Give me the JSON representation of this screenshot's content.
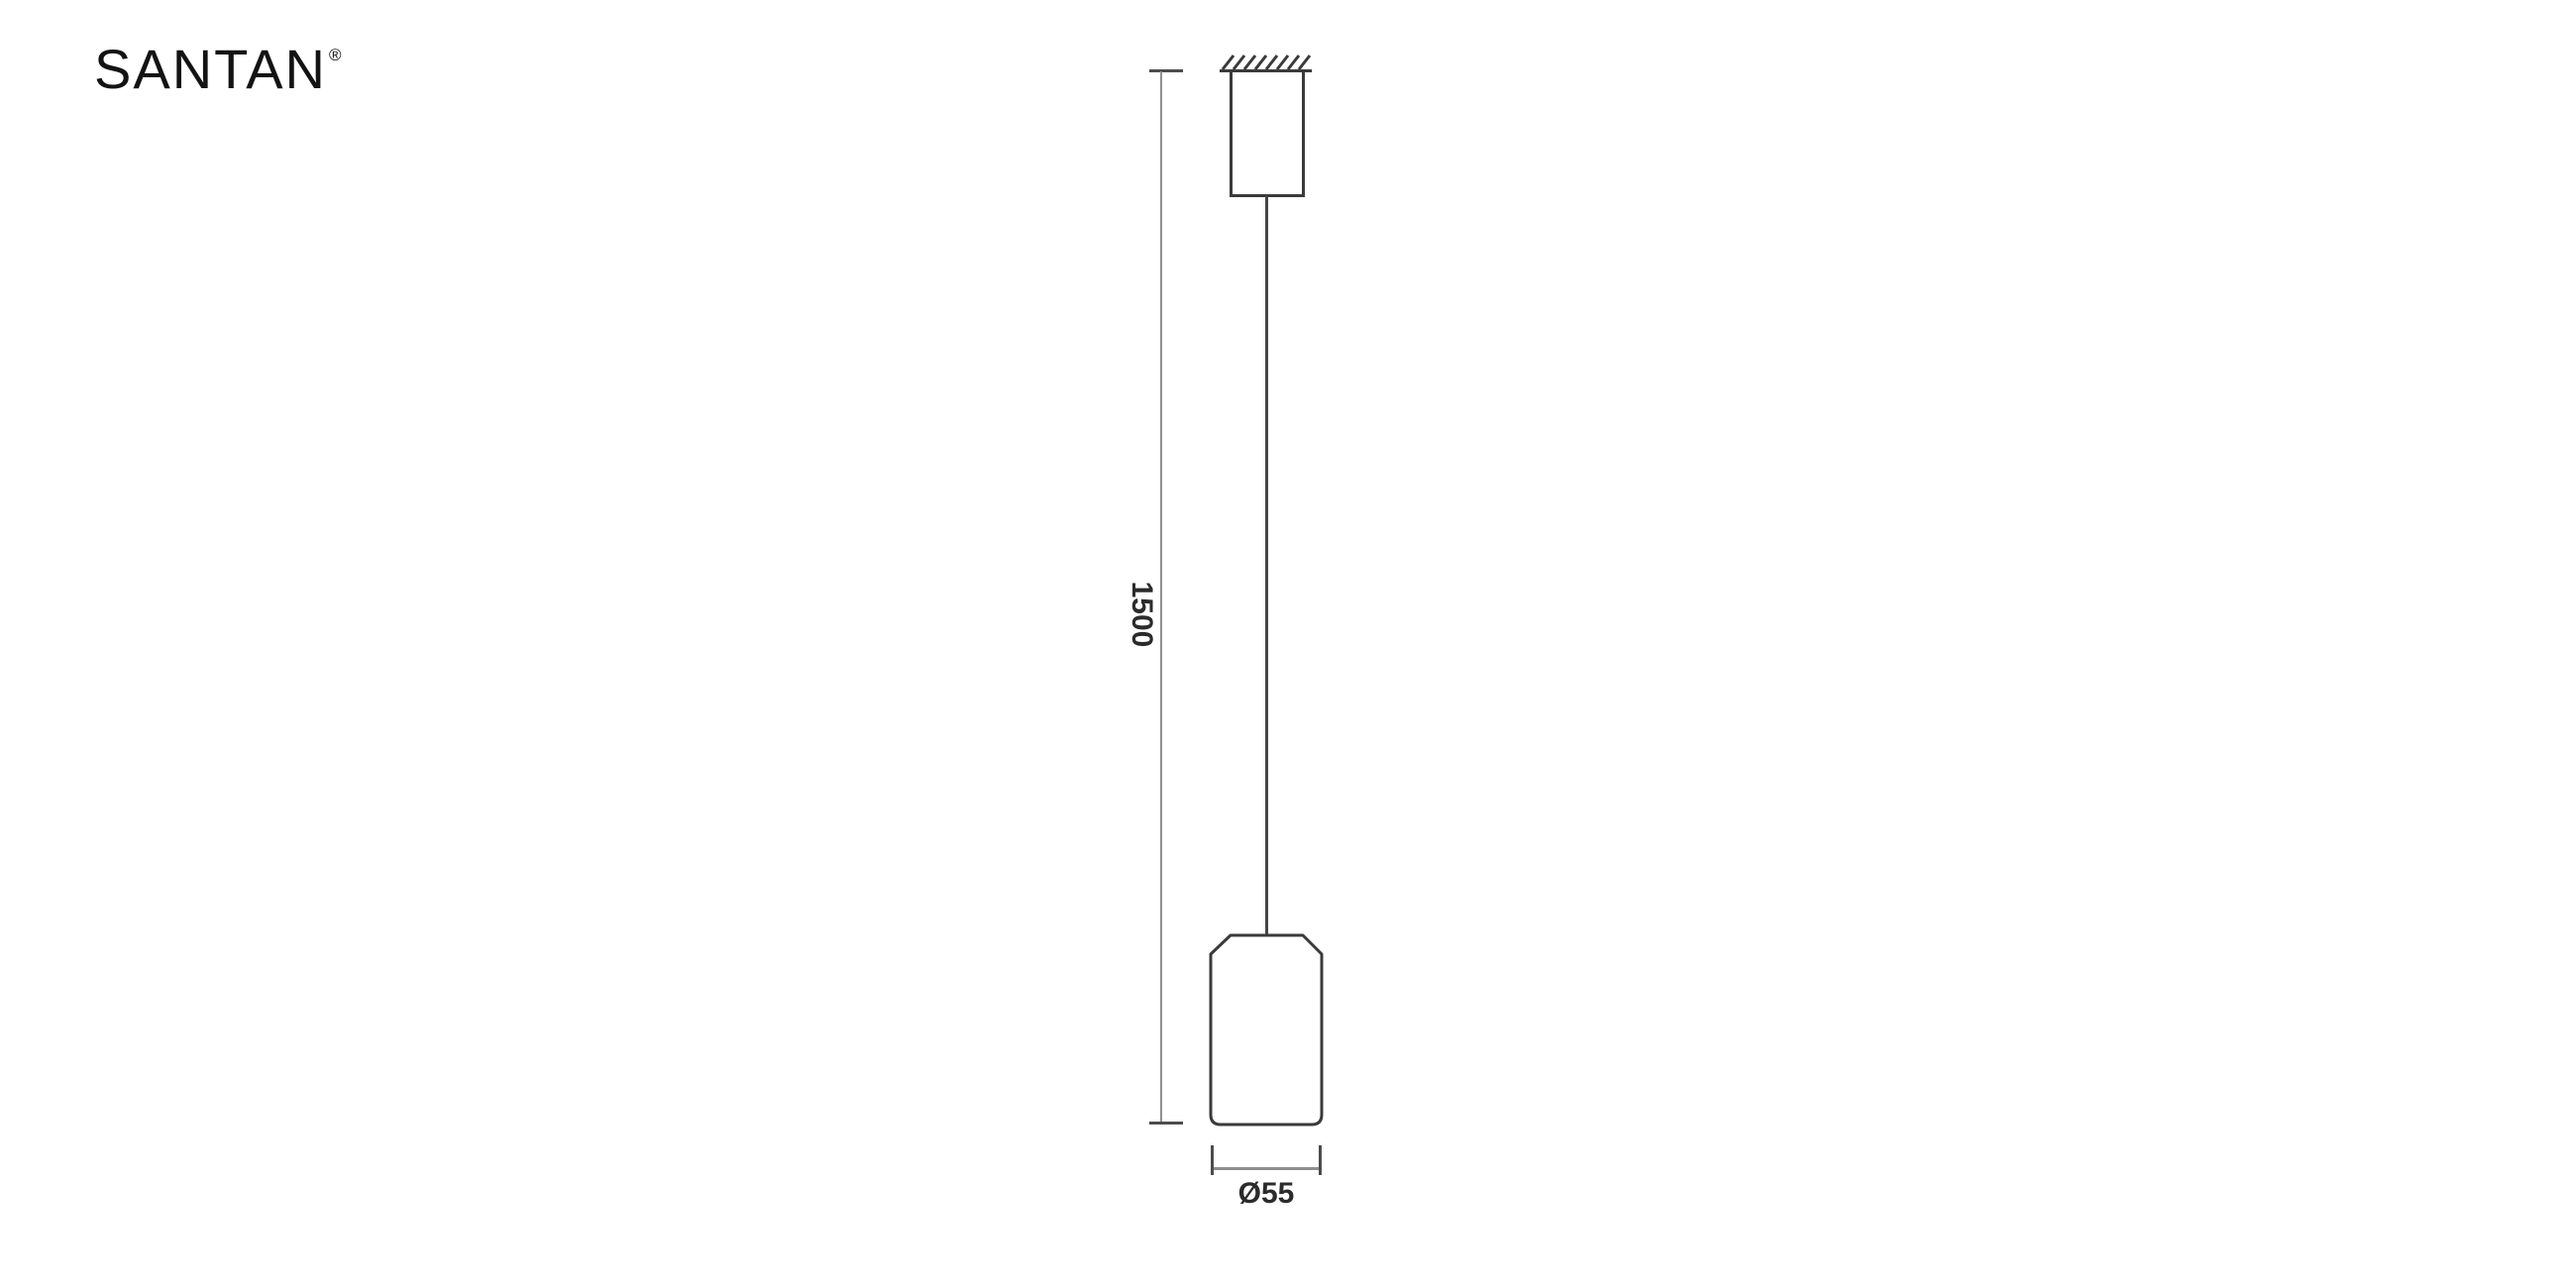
{
  "logo": {
    "text": "SANTAN",
    "registered_mark": "®"
  },
  "drawing": {
    "type": "pendant-lamp-dimension-drawing",
    "height_dimension": {
      "label": "1500",
      "value_mm": 1500,
      "orientation": "vertical"
    },
    "diameter_dimension": {
      "label": "Ø55",
      "value_mm": 55,
      "orientation": "horizontal"
    }
  },
  "icons": {
    "ceiling_hatch": "diagonal-hatch-lines"
  },
  "colors": {
    "background": "#ffffff",
    "outline_stroke": "#3a3a3a",
    "cable_stroke": "#454545",
    "dimension_line": "#8f8f8f",
    "dimension_tick": "#4c4c4c",
    "dimension_text": "#2b2b2b",
    "logo_text": "#131313"
  }
}
